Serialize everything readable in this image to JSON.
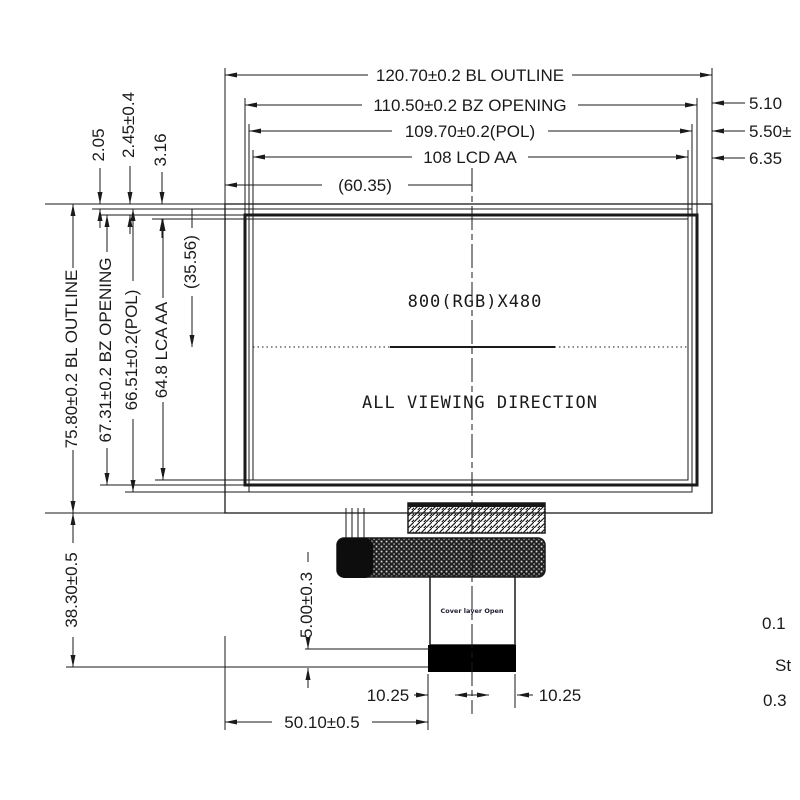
{
  "drawing": {
    "top_dims": {
      "bl_outline": "120.70±0.2 BL OUTLINE",
      "bz_opening": "110.50±0.2 BZ OPENING",
      "pol": "109.70±0.2(POL)",
      "lcd_aa": "108 LCD AA",
      "half_outline": "(60.35)"
    },
    "right_dims": {
      "d1": "5.10",
      "d2": "5.50±",
      "d3": "6.35"
    },
    "top_left_dims": {
      "d1": "2.05",
      "d2": "2.45±0.4",
      "d3": "3.16"
    },
    "left_dims": {
      "bl_outline": "75.80±0.2 BL OUTLINE",
      "bz_opening": "67.31±0.2 BZ OPENING",
      "pol": "66.51±0.2(POL)",
      "lcd_aa": "64.8 LCA AA",
      "half_aa": "(35.56)",
      "module_bottom": "38.30±0.5"
    },
    "bottom_dims": {
      "fpc_offset": "5.00±0.3",
      "left_half": "10.25",
      "right_half": "10.25",
      "fpc_center": "50.10±0.5"
    },
    "panel": {
      "resolution": "800(RGB)X480",
      "viewing_direction": "ALL VIEWING DIRECTION"
    },
    "fpc": {
      "tail_label": "Cover layer Open"
    },
    "edge_fragments": {
      "f1": "0.1",
      "f2": "St",
      "f3": "0.3"
    },
    "colors": {
      "line": "#1a1a1a",
      "fragment_orange": "#cf5f2e",
      "fragment_gray": "#3d3d3d"
    }
  }
}
